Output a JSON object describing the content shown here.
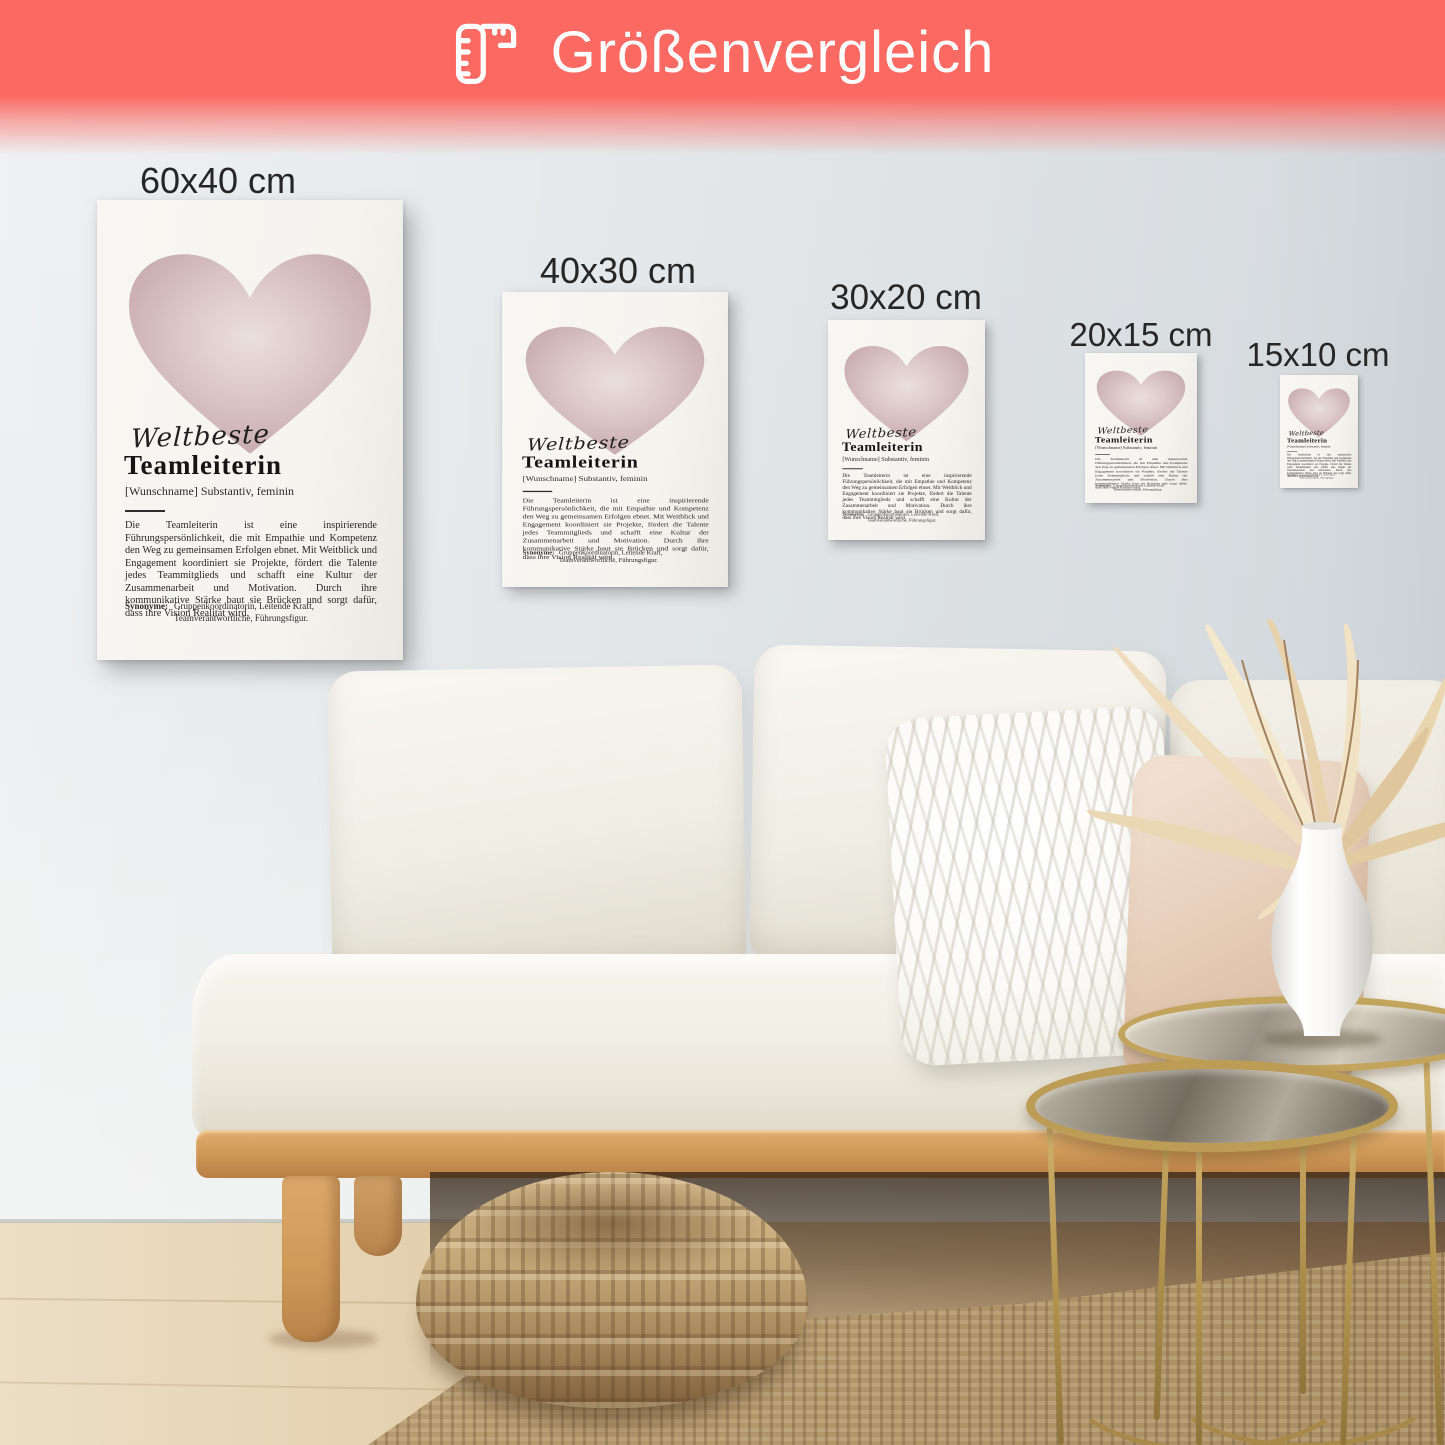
{
  "banner": {
    "label": "Größenvergleich",
    "icon": "folding-ruler-icon",
    "background": "#fb6a62",
    "text_color": "#ffffff"
  },
  "size_labels": [
    "60x40 cm",
    "40x30 cm",
    "30x20 cm",
    "20x15 cm",
    "15x10 cm"
  ],
  "poster": {
    "script_word": "Weltbeste",
    "title": "Teamleiterin",
    "subtitle": "[Wunschname] Substantiv, feminin",
    "body": "Die Teamleiterin ist eine inspirierende Führungspersönlichkeit, die mit Empathie und Kompetenz den Weg zu gemeinsamen Erfolgen ebnet. Mit Weitblick und Engagement koordiniert sie Projekte, fördert die Talente jedes Teammitglieds und schafft eine Kultur der Zusammenarbeit und Motivation. Durch ihre kommunikative Stärke baut sie Brücken und sorgt dafür, dass ihre Vision Realität wird.",
    "synonyms_label": "Synonyme:",
    "synonyms_text": "Gruppenkoordinatorin, Leitende Kraft, Teamverantwortliche, Führungsfigur.",
    "heart_color": "#d5bdc0"
  },
  "colors": {
    "wall": "#e5e8ea",
    "floor_wood": "#dcc3a0",
    "sofa_wood": "#c9965c",
    "rug_jute": "#b3976c",
    "table_gold": "#b5975c"
  }
}
